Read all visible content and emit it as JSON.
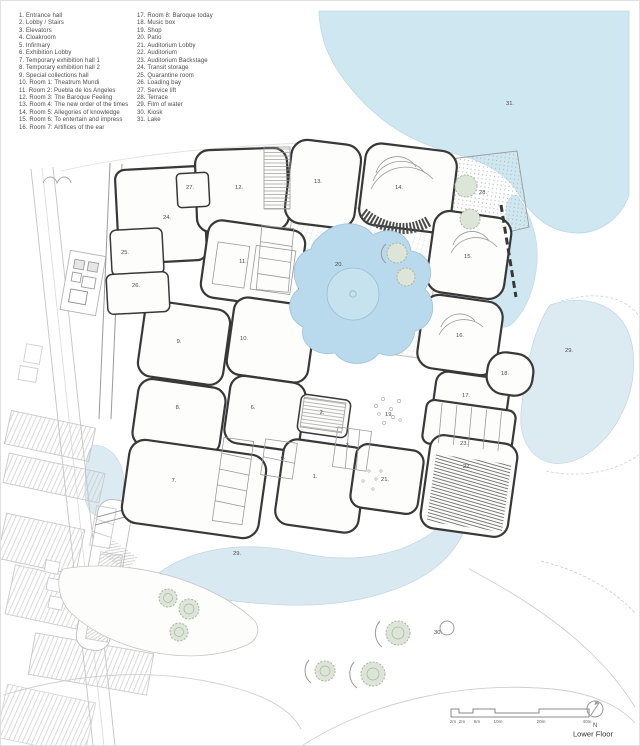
{
  "legend": {
    "col1": [
      {
        "n": "1.",
        "label": "Entrance hall"
      },
      {
        "n": "2.",
        "label": "Lobby / Stairs"
      },
      {
        "n": "3.",
        "label": "Elevators"
      },
      {
        "n": "4.",
        "label": "Cloakroom"
      },
      {
        "n": "5.",
        "label": "Infirmary"
      },
      {
        "n": "6.",
        "label": "Exhibition Lobby"
      },
      {
        "n": "7.",
        "label": "Temporary exhibition hall 1"
      },
      {
        "n": "8.",
        "label": "Temporary exhibition hall 2"
      },
      {
        "n": "9.",
        "label": "Special collections hall"
      },
      {
        "n": "10.",
        "label": "Room 1: Theatrum Mundi"
      },
      {
        "n": "11.",
        "label": "Room 2: Puebla de los Angeles"
      },
      {
        "n": "12.",
        "label": "Room 3: The Baroque Feeling"
      },
      {
        "n": "13.",
        "label": "Room 4: The new order of the times"
      },
      {
        "n": "14.",
        "label": "Room 5: Allegories of knowledge"
      },
      {
        "n": "15.",
        "label": "Room 6: To entertain and impress"
      },
      {
        "n": "16.",
        "label": "Room 7: Artifices of the ear"
      }
    ],
    "col2": [
      {
        "n": "17.",
        "label": "Room 8: Baroque today"
      },
      {
        "n": "18.",
        "label": "Music box"
      },
      {
        "n": "19.",
        "label": "Shop"
      },
      {
        "n": "20.",
        "label": "Patio"
      },
      {
        "n": "21.",
        "label": "Auditorium Lobby"
      },
      {
        "n": "22.",
        "label": "Auditorium"
      },
      {
        "n": "23.",
        "label": "Auditorium Backstage"
      },
      {
        "n": "24.",
        "label": "Transit storage"
      },
      {
        "n": "25.",
        "label": "Quarantine room"
      },
      {
        "n": "26.",
        "label": "Loading bay"
      },
      {
        "n": "27.",
        "label": "Service lift"
      },
      {
        "n": "28.",
        "label": "Terrace"
      },
      {
        "n": "29.",
        "label": "Film of water"
      },
      {
        "n": "30.",
        "label": "Kiosk"
      },
      {
        "n": "31.",
        "label": "Lake"
      }
    ]
  },
  "plan": {
    "labels": [
      {
        "t": "27.",
        "x": 189,
        "y": 187
      },
      {
        "t": "12.",
        "x": 238,
        "y": 187
      },
      {
        "t": "13.",
        "x": 317,
        "y": 181
      },
      {
        "t": "14.",
        "x": 398,
        "y": 187
      },
      {
        "t": "28.",
        "x": 482,
        "y": 192
      },
      {
        "t": "31.",
        "x": 509,
        "y": 103
      },
      {
        "t": "24.",
        "x": 166,
        "y": 217
      },
      {
        "t": "25.",
        "x": 124,
        "y": 252
      },
      {
        "t": "11.",
        "x": 242,
        "y": 261
      },
      {
        "t": "20.",
        "x": 338,
        "y": 264
      },
      {
        "t": "15.",
        "x": 467,
        "y": 256
      },
      {
        "t": "26.",
        "x": 135,
        "y": 285
      },
      {
        "t": "9.",
        "x": 178,
        "y": 341
      },
      {
        "t": "10.",
        "x": 243,
        "y": 338
      },
      {
        "t": "16.",
        "x": 459,
        "y": 335
      },
      {
        "t": "29.",
        "x": 568,
        "y": 350
      },
      {
        "t": "18.",
        "x": 504,
        "y": 373
      },
      {
        "t": "17.",
        "x": 465,
        "y": 395
      },
      {
        "t": "8.",
        "x": 177,
        "y": 407
      },
      {
        "t": "6.",
        "x": 252,
        "y": 407
      },
      {
        "t": "2.",
        "x": 321,
        "y": 412
      },
      {
        "t": "19.",
        "x": 388,
        "y": 414
      },
      {
        "t": "3.",
        "x": 347,
        "y": 445
      },
      {
        "t": "4.",
        "x": 282,
        "y": 457
      },
      {
        "t": "23.",
        "x": 463,
        "y": 443
      },
      {
        "t": "22.",
        "x": 466,
        "y": 466
      },
      {
        "t": "7.",
        "x": 173,
        "y": 480
      },
      {
        "t": "1.",
        "x": 314,
        "y": 476
      },
      {
        "t": "21.",
        "x": 384,
        "y": 479
      },
      {
        "t": "29.",
        "x": 236,
        "y": 553
      },
      {
        "t": "30.",
        "x": 437,
        "y": 632
      }
    ]
  },
  "footer": {
    "scale_ticks": [
      {
        "t": "2m",
        "x": 452
      },
      {
        "t": "2m",
        "x": 461
      },
      {
        "t": "6m",
        "x": 476
      },
      {
        "t": "10m",
        "x": 497
      },
      {
        "t": "20m",
        "x": 540
      },
      {
        "t": "40m",
        "x": 586
      }
    ],
    "north": "N",
    "title": "Lower Floor"
  },
  "colors": {
    "lake": "#cfe7f1",
    "film_of_water": "#dceaf2",
    "pond": "#b9d9ec",
    "wall": "#383838",
    "tree": "#dde4d8",
    "text": "#4a4a4a"
  }
}
